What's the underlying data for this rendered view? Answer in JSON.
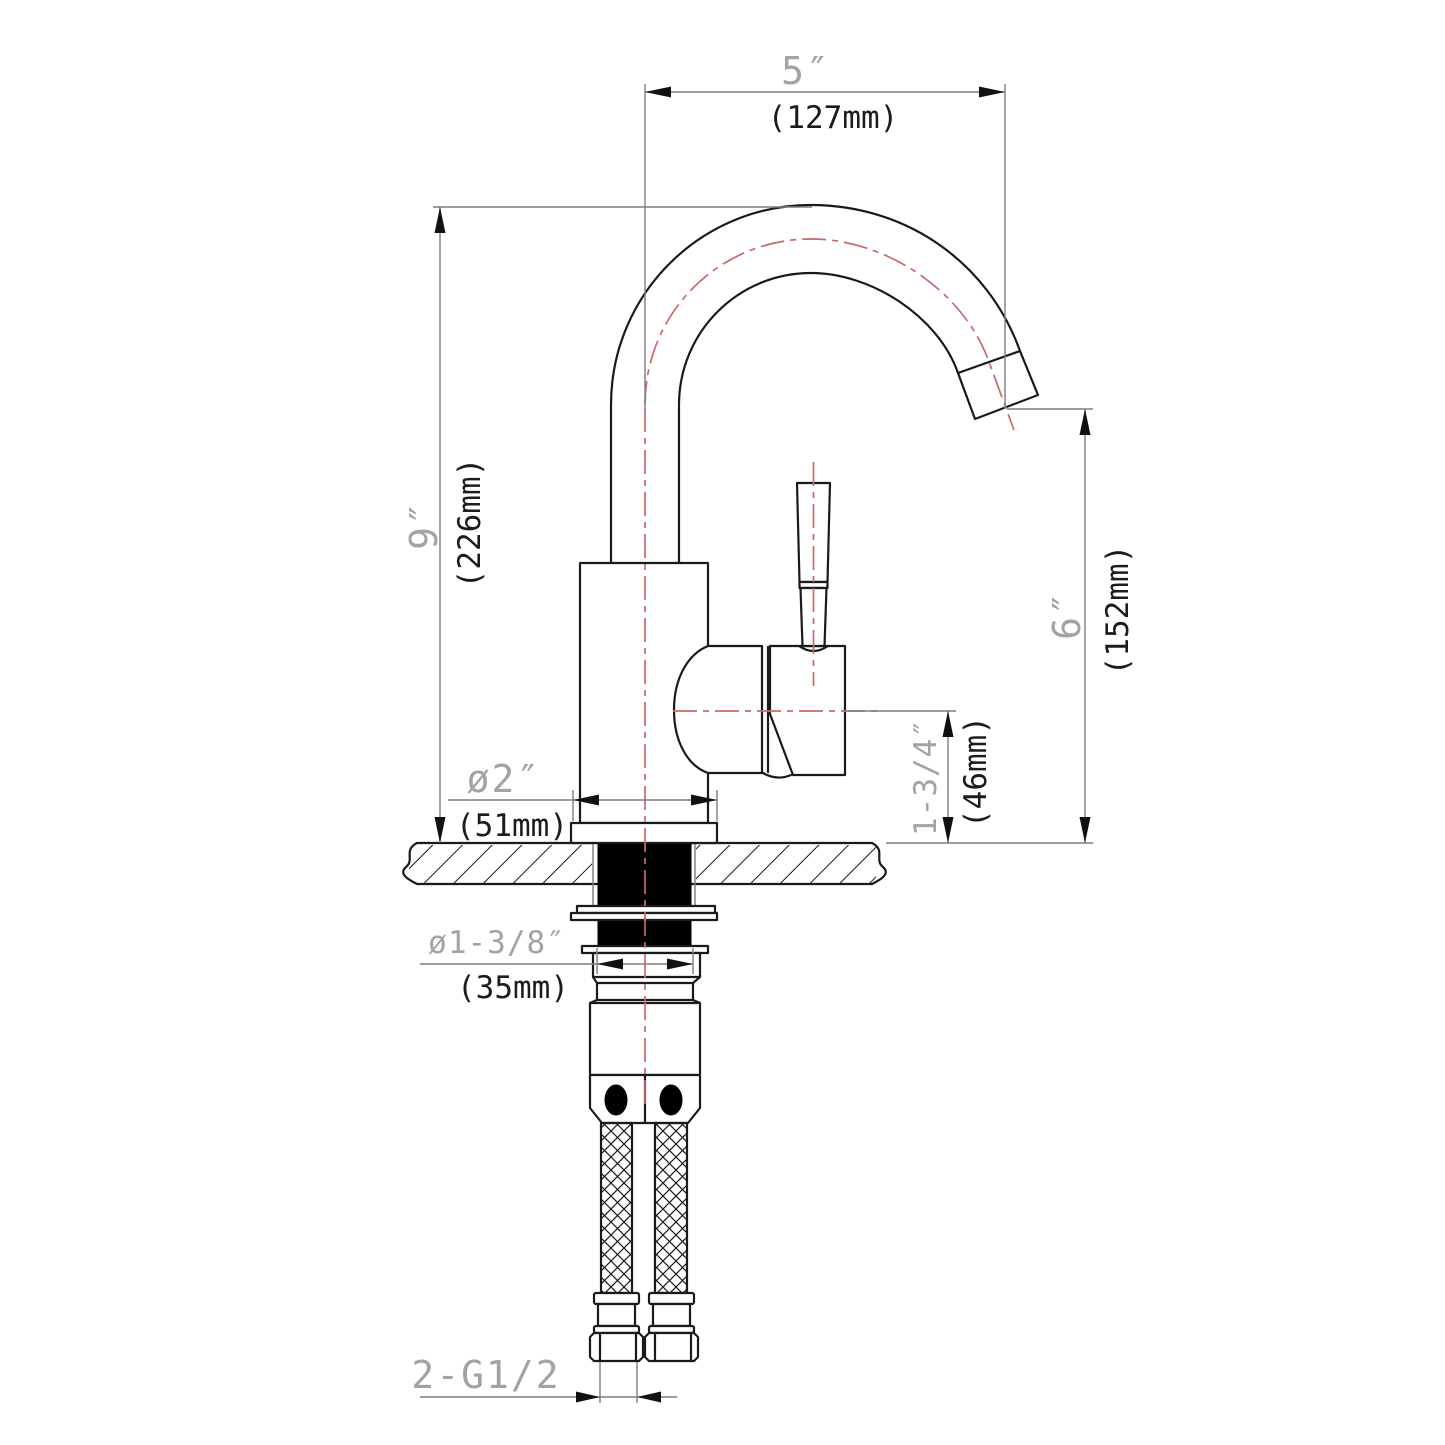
{
  "drawing": {
    "type": "faucet-installation-dimension-drawing",
    "dimensions": {
      "spout_reach": {
        "inch": "5″",
        "mm": "(127mm)"
      },
      "overall_height": {
        "inch": "9″",
        "mm": "(226mm)"
      },
      "outlet_height": {
        "inch": "6″",
        "mm": "(152mm)"
      },
      "handle_center_height": {
        "inch": "1-3/4″",
        "mm": "(46mm)"
      },
      "base_diameter": {
        "inch": "ø2″",
        "mm": "(51mm)"
      },
      "shank_diameter": {
        "inch": "ø1-3/8″",
        "mm": "(35mm)"
      },
      "supply_thread": {
        "label": "2-G1/2"
      }
    },
    "colors": {
      "outline": "#1a1a1a",
      "dimension_line": "#7e7e7e",
      "centerline_red": "#c96a6a",
      "inch_text": "#a3a3a3",
      "mm_text": "#1c1c1c"
    }
  }
}
